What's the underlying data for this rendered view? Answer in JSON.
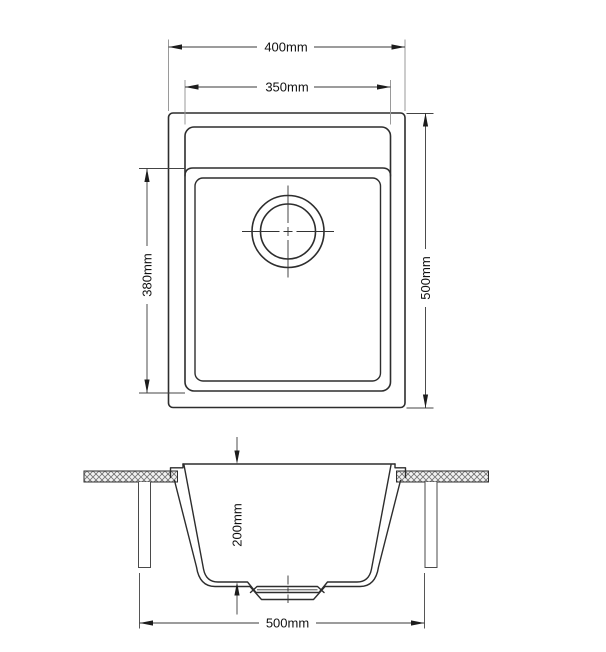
{
  "views": {
    "plan": {
      "dimensions": {
        "overall_width": "400mm",
        "bowl_width": "350mm",
        "bowl_length": "380mm",
        "overall_length": "500mm"
      }
    },
    "section": {
      "dimensions": {
        "bowl_depth": "200mm",
        "base_width": "500mm"
      }
    }
  },
  "colors": {
    "background": "#ffffff",
    "object_line": "#2d2d2d",
    "dimension_line": "#3a3a3a",
    "extension_line_gray": "#9a9a9a",
    "hatch": "#777777",
    "text": "#111111"
  }
}
